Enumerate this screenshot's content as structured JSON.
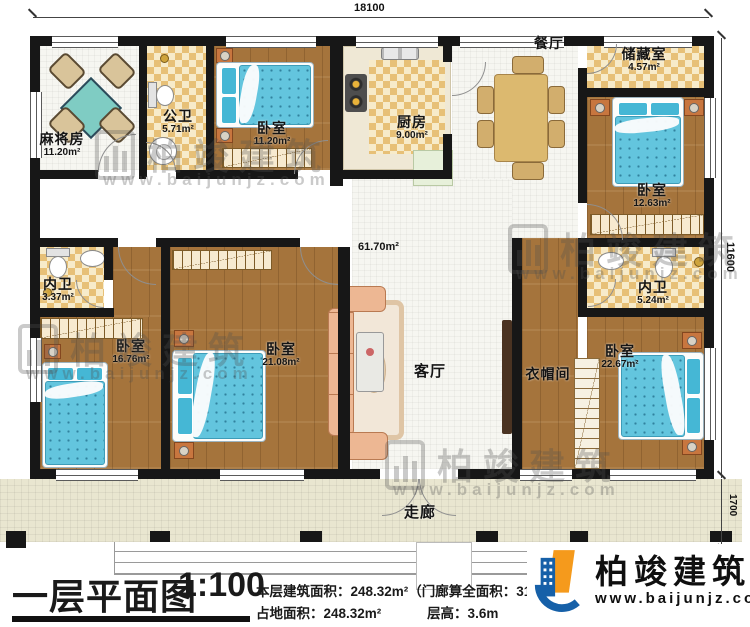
{
  "dimensions": {
    "top": "18100",
    "right_main": "11600",
    "right_porch": "1700"
  },
  "rooms": {
    "mahjong": {
      "name": "麻将房",
      "area": "11.20m²"
    },
    "public_bath": {
      "name": "公卫",
      "area": "5.71m²"
    },
    "bedroom_top": {
      "name": "卧室",
      "area": "11.20m²"
    },
    "kitchen": {
      "name": "厨房",
      "area": "9.00m²"
    },
    "dining": {
      "name": "餐厅"
    },
    "storage": {
      "name": "储藏室",
      "area": "4.57m²"
    },
    "bedroom_tr": {
      "name": "卧室",
      "area": "12.63m²"
    },
    "bath_left": {
      "name": "内卫",
      "area": "3.37m²"
    },
    "bedroom_bl1": {
      "name": "卧室",
      "area": "16.76m²"
    },
    "bedroom_bl2": {
      "name": "卧室",
      "area": "21.08m²"
    },
    "living": {
      "name": "客厅"
    },
    "open_area": {
      "area": "61.70m²"
    },
    "bath_right": {
      "name": "内卫",
      "area": "5.24m²"
    },
    "cloakroom": {
      "name": "衣帽间"
    },
    "bedroom_br": {
      "name": "卧室",
      "area": "22.67m²"
    },
    "corridor": {
      "name": "走廊"
    }
  },
  "title_block": {
    "title": "一层平面图",
    "scale": "1:100",
    "info_line1": "本层建筑面积：248.32m²（门廊算全面积：31.1",
    "info_line2_left": "占地面积：248.32m²",
    "info_line2_right": "层高：3.6m"
  },
  "branding": {
    "logo_name": "柏竣建筑",
    "logo_url": "www.baijunjz.com"
  },
  "watermark": {
    "name": "柏竣建筑",
    "url": "www.baijunjz.com"
  },
  "colors": {
    "wall": "#171717",
    "wood_floor": "#a5743c",
    "checker_tile": "#e7c077",
    "bed_blue": "#63c5de",
    "logo_blue": "#1660a8",
    "logo_orange": "#f59a1c"
  }
}
